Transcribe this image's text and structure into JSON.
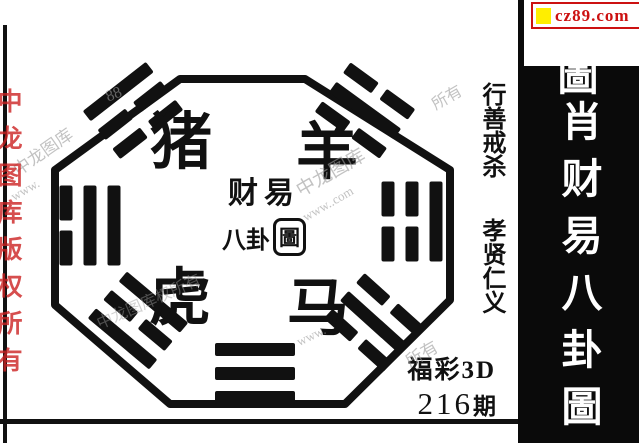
{
  "branding": {
    "site": "cz89.com",
    "accent_red": "#cc1111",
    "accent_yellow": "#ffee00"
  },
  "right_banner": {
    "partial_top_char": "圖",
    "title": "肖财易八卦圖"
  },
  "side_column": {
    "text_top": "行善戒杀",
    "text_bottom": "孝贤仁义"
  },
  "octagon": {
    "animals": [
      {
        "name": "pig",
        "char": "猪"
      },
      {
        "name": "goat",
        "char": "羊"
      },
      {
        "name": "tiger",
        "char": "虎"
      },
      {
        "name": "horse",
        "char": "马"
      }
    ],
    "center": {
      "line1": "财易",
      "line2_prefix": "八卦",
      "line2_seal": "圖"
    },
    "trigrams": [
      {
        "position": "top-left",
        "lines": [
          1,
          0,
          0
        ]
      },
      {
        "position": "top-right",
        "lines": [
          0,
          1,
          0
        ]
      },
      {
        "position": "left",
        "lines": [
          0,
          1,
          1
        ]
      },
      {
        "position": "right",
        "lines": [
          1,
          0,
          0
        ]
      },
      {
        "position": "bottom-left",
        "lines": [
          1,
          0,
          1
        ]
      },
      {
        "position": "bottom-right",
        "lines": [
          0,
          1,
          0
        ]
      },
      {
        "position": "bottom",
        "lines": [
          1,
          1,
          1
        ]
      }
    ]
  },
  "issue": {
    "game": "福彩3D",
    "number": "216",
    "suffix": "期"
  },
  "watermarks": {
    "red_vertical": "中龙图库版权所有",
    "gray": [
      "中龙图库",
      "www.",
      "88",
      "中龙图库",
      "www..com",
      "中龙图库权所有",
      "所有",
      "所有",
      "www."
    ]
  }
}
